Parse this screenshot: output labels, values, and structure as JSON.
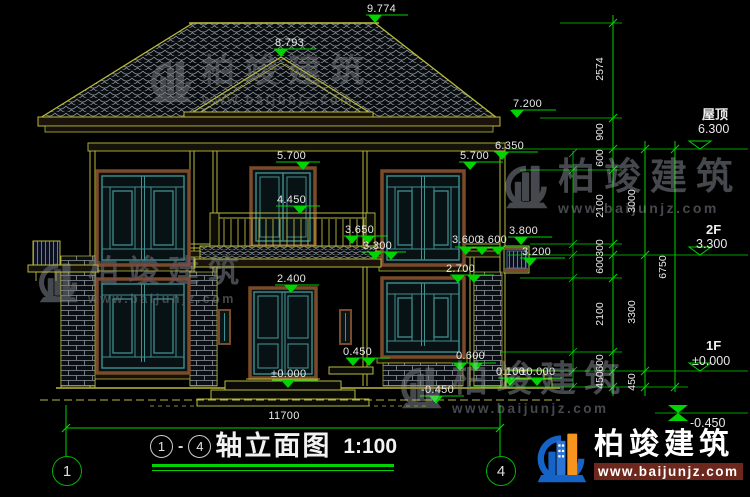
{
  "drawing_title": {
    "axis_start": "1",
    "separator": "-",
    "axis_end": "4",
    "name": "轴立面图",
    "scale": "1:100"
  },
  "axes": {
    "left": "1",
    "right": "4"
  },
  "bottom_dim": "11700",
  "levels": [
    {
      "name": "屋顶",
      "elev": "6.300"
    },
    {
      "name": "2F",
      "elev": "3.300"
    },
    {
      "name": "1F",
      "elev": "±0.000"
    },
    {
      "name": "",
      "elev": "-0.450"
    }
  ],
  "spots": {
    "ridge_main": "9.774",
    "ridge_front": "8.793",
    "eave_main": "7.200",
    "eave_secondary": "6.350",
    "window_top_center": "5.700",
    "window_top_right": "5.700",
    "balcony_rail": "4.450",
    "porch_eave": "3.650",
    "floor2": "3.300",
    "band_left": "3.600",
    "band_right": "3.600",
    "stair_window_top": "3.800",
    "stair_window_bottom": "3.200",
    "window1f_top": "2.700",
    "door_top": "2.400",
    "door_level": "±0.000",
    "ledge": "0.450",
    "sill_right": "0.600",
    "terrace": "0.100",
    "ground_right": "±0.000",
    "ground_center": "-0.450"
  },
  "dim_chains": {
    "inner": [
      "2574",
      "900",
      "600",
      "2100",
      "300",
      "600",
      "2100",
      "600",
      "450"
    ],
    "middle": [
      "3000",
      "3300",
      "450"
    ],
    "outer": [
      "6750"
    ]
  },
  "watermark": {
    "brand": "柏竣建筑",
    "url": "www.baijunjz.com"
  },
  "colors": {
    "line_yellow": "#b9b93c",
    "dim_green": "#00d400",
    "teal": "#3f9090",
    "frame_brown": "#7b4a28",
    "watermark_gray": "#45484c",
    "logo_blue": "#1663c7",
    "logo_orange": "#f7941d"
  }
}
